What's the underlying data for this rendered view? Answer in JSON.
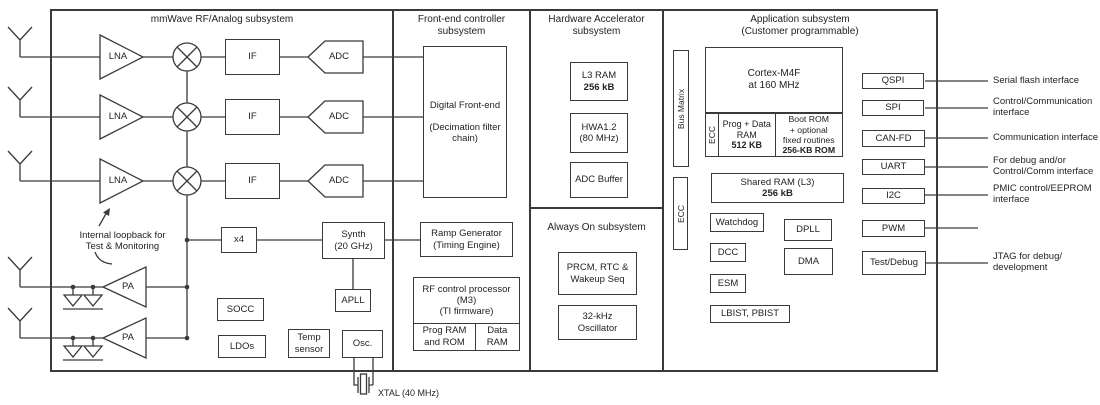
{
  "mmwave": {
    "title": "mmWave RF/Analog subsystem",
    "lna": "LNA",
    "if_label": "IF",
    "adc": "ADC",
    "pa": "PA",
    "loopback_line1": "Internal loopback for",
    "loopback_line2": "Test & Monitoring",
    "x4": "x4",
    "synth_line1": "Synth",
    "synth_line2": "(20 GHz)",
    "apll": "APLL",
    "socc": "SOCC",
    "ldos": "LDOs",
    "temp_line1": "Temp",
    "temp_line2": "sensor",
    "osc": "Osc.",
    "xtal": "XTAL (40 MHz)"
  },
  "frontend": {
    "title_line1": "Front-end controller",
    "title_line2": "subsystem",
    "dfe_line1": "Digital Front-end",
    "dfe_line2": "(Decimation filter",
    "dfe_line3": "chain)",
    "ramp_line1": "Ramp Generator",
    "ramp_line2": "(Timing Engine)",
    "rfproc_line1": "RF control  processor",
    "rfproc_line2": "(M3)",
    "rfproc_line3": "(TI firmware)",
    "prog_ram_line1": "Prog RAM",
    "prog_ram_line2": "and ROM",
    "data_ram_line1": "Data",
    "data_ram_line2": "RAM"
  },
  "hwa": {
    "title_line1": "Hardware Accelerator",
    "title_line2": "subsystem",
    "l3ram_line1": "L3 RAM",
    "l3ram_line2": "256 kB",
    "hwa_line1": "HWA1.2",
    "hwa_line2": "(80 MHz)",
    "adc_buffer": "ADC Buffer"
  },
  "always_on": {
    "title": "Always On subsystem",
    "prcm_line1": "PRCM, RTC &",
    "prcm_line2": "Wakeup Seq",
    "osc32k_line1": "32-kHz",
    "osc32k_line2": "Oscillator"
  },
  "app": {
    "title_line1": "Application subsystem",
    "title_line2": "(Customer programmable)",
    "bus_matrix": "Bus Matrix",
    "ecc": "ECC",
    "cortex_line1": "Cortex-M4F",
    "cortex_line2": "at 160 MHz",
    "prog_data_line1": "Prog + Data",
    "prog_data_line2": "RAM",
    "prog_data_line3": "512 KB",
    "bootrom_line1": "Boot ROM",
    "bootrom_line2": "+ optional",
    "bootrom_line3": "fixed routines",
    "bootrom_line4": "256-KB ROM",
    "shared_line1": "Shared RAM (L3)",
    "shared_line2": "256 kB",
    "watchdog": "Watchdog",
    "dpll": "DPLL",
    "dcc": "DCC",
    "dma": "DMA",
    "esm": "ESM",
    "lbist": "LBIST, PBIST"
  },
  "interfaces": {
    "qspi": "QSPI",
    "spi": "SPI",
    "canfd": "CAN-FD",
    "uart": "UART",
    "i2c": "I2C",
    "pwm": "PWM",
    "testdebug": "Test/Debug"
  },
  "annotations": {
    "qspi": "Serial flash interface",
    "spi_line1": "Control/Communication",
    "spi_line2": "interface",
    "canfd": "Communication interface",
    "uart_line1": "For debug and/or",
    "uart_line2": "Control/Comm interface",
    "i2c_line1": "PMIC control/EEPROM",
    "i2c_line2": "interface",
    "jtag_line1": "JTAG for debug/",
    "jtag_line2": "development"
  },
  "colors": {
    "line": "#3a3a3a",
    "background": "#ffffff"
  }
}
